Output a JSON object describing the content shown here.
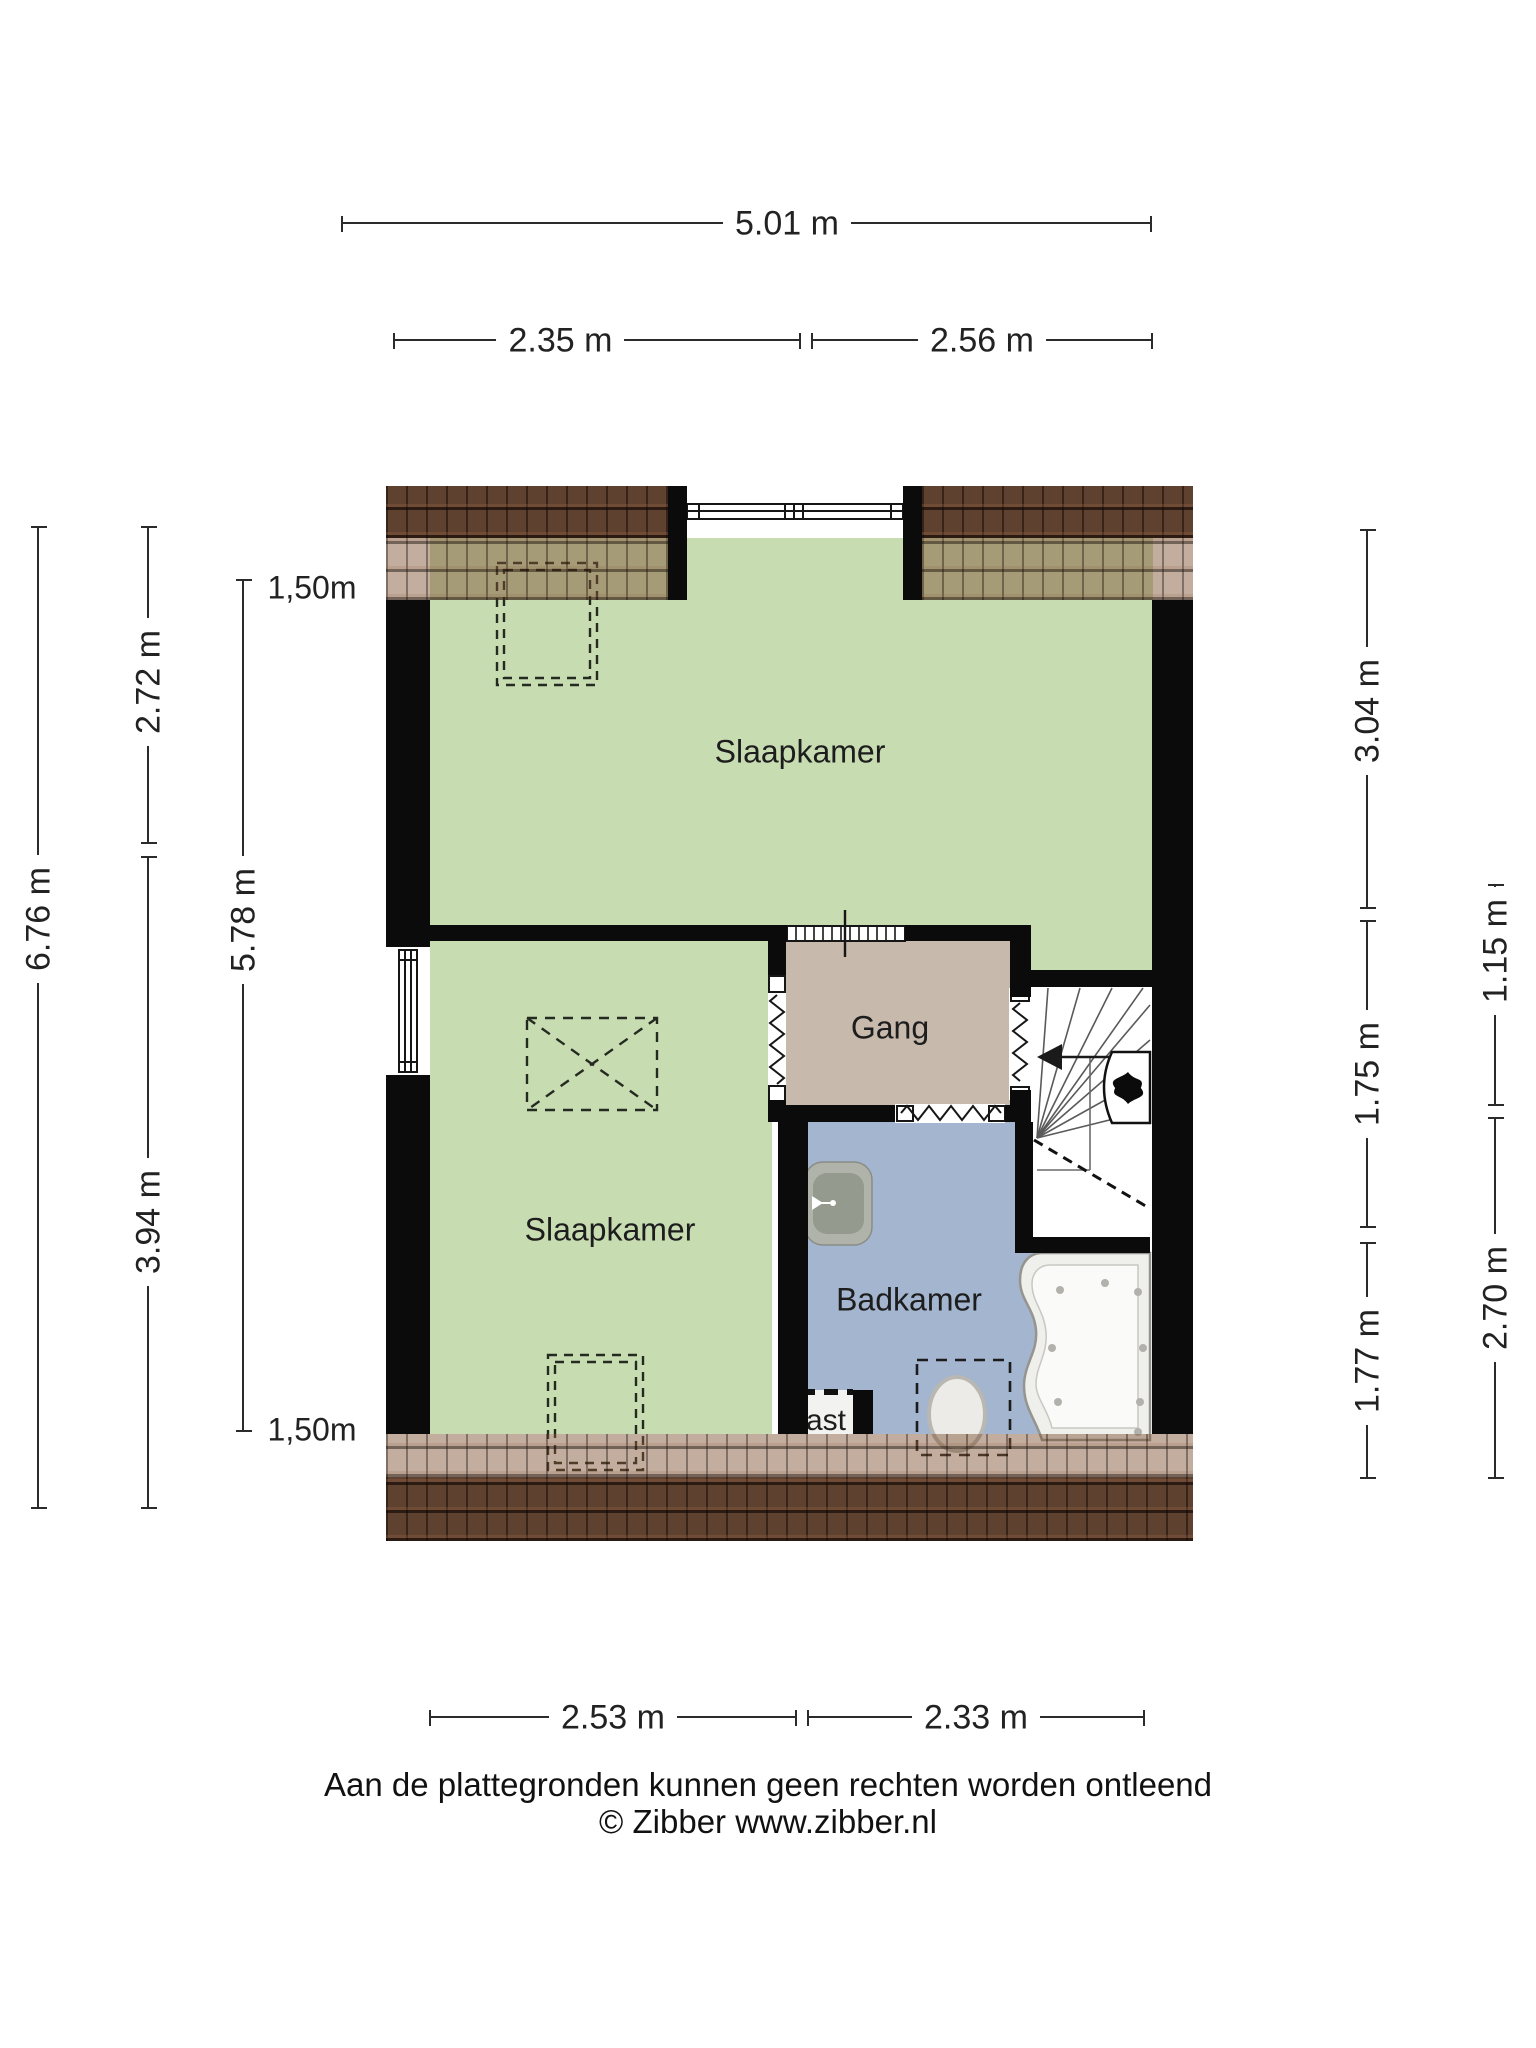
{
  "rooms": {
    "bedroom_top": "Slaapkamer",
    "bedroom_bottom": "Slaapkamer",
    "hallway": "Gang",
    "bathroom": "Badkamer",
    "closet": "Kast"
  },
  "dimensions": {
    "top_total": "5.01 m",
    "top_left": "2.35 m",
    "top_right": "2.56 m",
    "left_total": "6.76 m",
    "left_upper": "2.72 m",
    "left_inner": "5.78 m",
    "left_lower": "3.94 m",
    "height_line_top": "1,50m",
    "height_line_bottom": "1,50m",
    "right_upper": "3.04 m",
    "right_middle": "1.75 m",
    "right_inner": "1.15 m",
    "right_lower": "1.77 m",
    "right_outer_lower": "2.70 m",
    "bottom_left": "2.53 m",
    "bottom_right": "2.33 m"
  },
  "footer": {
    "line1": "Aan de plattegronden kunnen geen rechten worden ontleend",
    "line2": "© Zibber www.zibber.nl"
  },
  "colors": {
    "bedroom_fill": "#c8dcb2",
    "hallway_fill": "#c7b9ab",
    "bathroom_fill": "#a3b5cf",
    "wall": "#0b0b0b",
    "roof_dark": "#5f4130",
    "dimension_text": "#222222"
  }
}
